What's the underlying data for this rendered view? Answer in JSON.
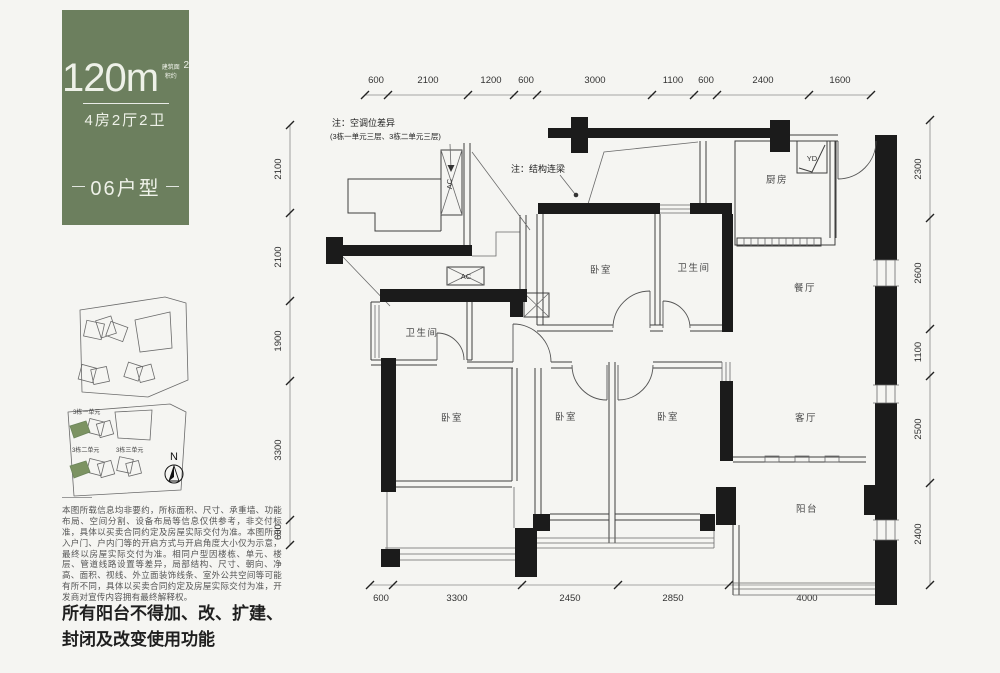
{
  "colors": {
    "panel_green": "#6c7f5e",
    "highlight_green": "#7c9362",
    "page_bg": "#f5f5f2",
    "wall_black": "#1b1b1b"
  },
  "left_panel": {
    "area_prefix": "建筑面积约",
    "area_value": "120m",
    "area_sup": "2",
    "layout_label": "4房2厅2卫",
    "unit_label": "06户型"
  },
  "site_plan": {
    "building_labels": [
      "3栋一单元",
      "3栋二单元",
      "3栋三单元"
    ],
    "north_label": "N"
  },
  "disclaimer": "本图所载信息均非要约，所标面积、尺寸、承重墙、功能布局、空间分割、设备布局等信息仅供参考，非交付标准，具体以买卖合同约定及房屋实际交付为准。本图所示入户门、户内门等的开启方式与开启角度大小仅为示意，最终以房屋实际交付为准。相同户型因楼栋、单元、楼层、管道线路设置等差异，局部结构、尺寸、朝向、净高、面积、视线、外立面装饰线条、室外公共空间等可能有所不同，具体以买卖合同约定及房屋实际交付为准，开发商对宣传内容拥有最终解释权。",
  "balcony_notice_line1": "所有阳台不得加、改、扩建、",
  "balcony_notice_line2": "封闭及改变使用功能",
  "floor_plan": {
    "notes": {
      "ac_note_title": "注：空调位差异",
      "ac_note_detail": "(3栋一单元三层、3栋二单元三层)",
      "beam_note": "注：结构连梁"
    },
    "room_labels": {
      "kitchen": "厨房",
      "dining": "餐厅",
      "living": "客厅",
      "balcony": "阳台",
      "bedroom": "卧室",
      "bathroom": "卫生间",
      "flue": "YD",
      "ac": "AC"
    },
    "dimensions": {
      "top": [
        "600",
        "2100",
        "1200",
        "600",
        "3000",
        "1100",
        "600",
        "2400",
        "1600"
      ],
      "left": [
        "2100",
        "2100",
        "1900",
        "3300",
        "600"
      ],
      "right": [
        "2300",
        "2600",
        "1100",
        "2500",
        "2400"
      ],
      "bottom": [
        "600",
        "3300",
        "2450",
        "2850",
        "4000"
      ]
    }
  }
}
